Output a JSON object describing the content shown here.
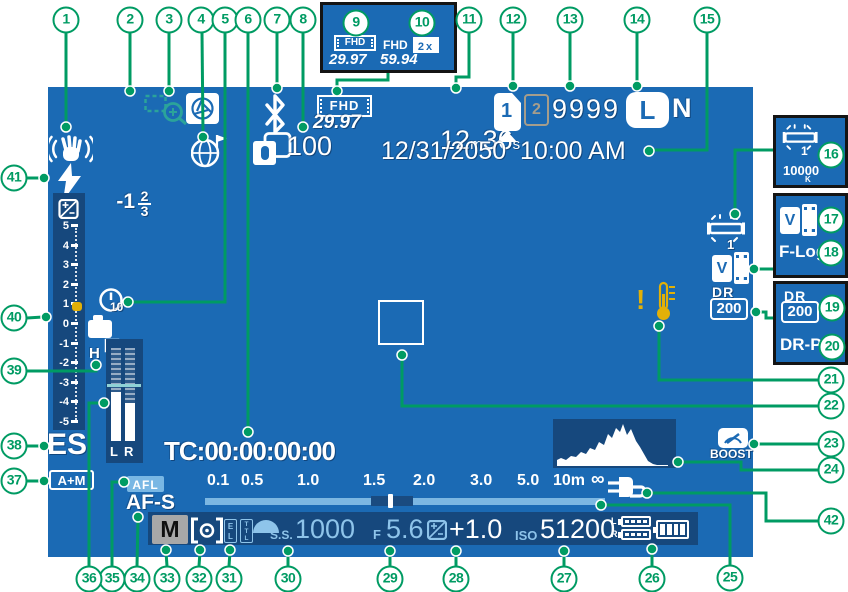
{
  "colors": {
    "screen_blue": "#1b6ab4",
    "panel_navy": "#16487d",
    "callout_green": "#009b63",
    "warning_yellow": "#e2b007",
    "light_blue_text": "#8ec4ea",
    "zoom_teal": "#2ba39a"
  },
  "callouts": {
    "c1": "1",
    "c2": "2",
    "c3": "3",
    "c4": "4",
    "c5": "5",
    "c6": "6",
    "c7": "7",
    "c8": "8",
    "c9": "9",
    "c10": "10",
    "c11": "11",
    "c12": "12",
    "c13": "13",
    "c14": "14",
    "c15": "15",
    "c16": "16",
    "c17": "17",
    "c18": "18",
    "c19": "19",
    "c20": "20",
    "c21": "21",
    "c22": "22",
    "c23": "23",
    "c24": "24",
    "c25": "25",
    "c26": "26",
    "c27": "27",
    "c28": "28",
    "c29": "29",
    "c30": "30",
    "c31": "31",
    "c32": "32",
    "c33": "33",
    "c34": "34",
    "c35": "35",
    "c36": "36",
    "c37": "37",
    "c38": "38",
    "c39": "39",
    "c40": "40",
    "c41": "41",
    "c42": "42"
  },
  "screen": {
    "transfer_count": "100",
    "movie_format": "FHD",
    "movie_rate": "29.97",
    "time_min": "12",
    "unit_m": "m",
    "time_sec": "36",
    "unit_s": "s",
    "card1": "1",
    "card2": "2",
    "frames": "9999",
    "size": "L",
    "quality": "N",
    "datetime": "12/31/2050  10:00 AM",
    "flash_int": "-1",
    "flash_num": "2",
    "flash_den": "3",
    "ev_ticks": [
      "5",
      "4",
      "3",
      "2",
      "1",
      "0",
      "-1",
      "-2",
      "-3",
      "-4",
      "-5"
    ],
    "timer": "10",
    "drive": "H",
    "audio_l": "L",
    "audio_r": "R",
    "shutter_type": "ES",
    "focus_mm": "A+M",
    "afl": "AFL",
    "af_mode": "AF-S",
    "timecode": "TC:00:00:00:00",
    "wb_preset": "1",
    "film_v": "V",
    "dr": "DR",
    "dr_value": "200",
    "warning": "!",
    "boost": "BOOST",
    "dist": [
      "0.1",
      "0.5",
      "1.0",
      "1.5",
      "2.0",
      "3.0",
      "5.0",
      "10m",
      "∞"
    ],
    "mode": "M",
    "el": [
      "E",
      "L"
    ],
    "ttl": [
      "T",
      "T",
      "L"
    ],
    "ss": "S.S.",
    "shutter_speed": "1000",
    "f": "F",
    "aperture": "5.6",
    "exp_comp": "+1.0",
    "iso": "ISO",
    "iso_value": "51200",
    "batt_l": "L",
    "batt_r": "R"
  },
  "insets": {
    "movie_fhd1": "FHD",
    "movie_rate1": "29.97",
    "movie_fhd2": "FHD",
    "movie_mult": "2x",
    "movie_rate2": "59.94",
    "wb_preset": "1",
    "wb_kelvin": "10000",
    "wb_unit": "K",
    "film_v": "V",
    "flog": "F-Log",
    "dr": "DR",
    "dr_value": "200",
    "drp": "DR-P"
  }
}
